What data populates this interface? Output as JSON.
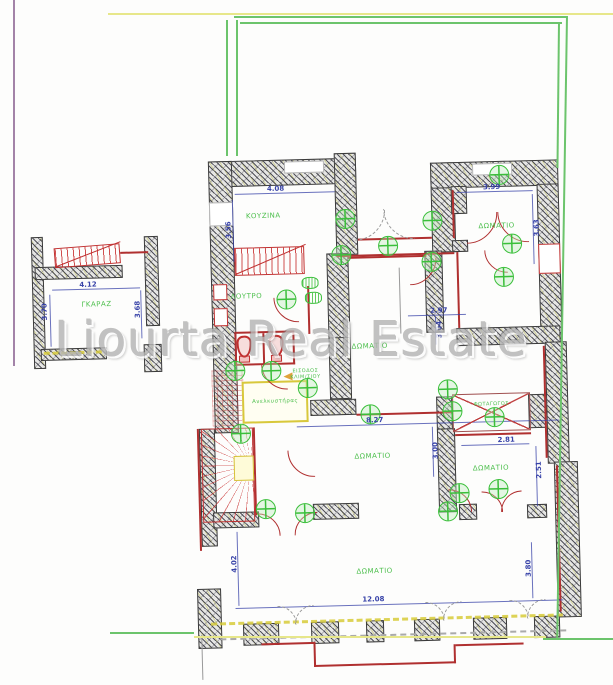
{
  "watermark": {
    "text": "Liourta Real Estate"
  },
  "colors": {
    "boundary_green": "#6cc46c",
    "line_yellow": "#e7e78a",
    "line_purple": "#a383a8",
    "wall_dark": "#3a3a3a",
    "dimension_blue": "#3742a8",
    "door_red": "#b03030",
    "label_green": "#4cbf4c",
    "symbol_green": "#3abf3a",
    "elevator_yellow": "#d8c83c",
    "watermark_gray": "#b5b5b5"
  },
  "plan": {
    "labels": [
      {
        "id": "kitchen",
        "text": "ΚΟΥΖΙΝΑ",
        "x": 268,
        "y": 213
      },
      {
        "id": "room-top-right",
        "text": "ΔΩΜΑΤΙΟ",
        "x": 501,
        "y": 229
      },
      {
        "id": "garage",
        "text": "ΓΚΑΡΑΖ",
        "x": 99,
        "y": 297
      },
      {
        "id": "bathroom",
        "text": "ΛΟΥΤΡΟ",
        "x": 249,
        "y": 293
      },
      {
        "id": "room-middle",
        "text": "ΔΩΜΑΤΙΟ",
        "x": 371,
        "y": 346
      },
      {
        "id": "stair-entrance",
        "text": "ΕΙΣΟΔΟΣ\nΚΛΙΜ/ΣΙΟΥ",
        "x": 306,
        "y": 372,
        "size": 5
      },
      {
        "id": "elevator",
        "text": "Ανελκυστήρας",
        "x": 275,
        "y": 399,
        "size": 5.5
      },
      {
        "id": "lightwell",
        "text": "ΦΩΤΑΓΩΓΟΣ",
        "x": 491,
        "y": 407,
        "size": 5
      },
      {
        "id": "room-mid-bottom",
        "text": "ΔΩΜΑΤΙΟ",
        "x": 371,
        "y": 456
      },
      {
        "id": "room-bottom-right",
        "text": "ΔΩΜΑΤΙΟ",
        "x": 489,
        "y": 471
      },
      {
        "id": "room-bottom",
        "text": "ΔΩΜΑΤΙΟ",
        "x": 370,
        "y": 571
      }
    ],
    "dimensions": [
      {
        "text": "4.08",
        "x": 281,
        "y": 186,
        "vertical": false
      },
      {
        "text": "3.56",
        "x": 233,
        "y": 226,
        "vertical": true
      },
      {
        "text": "3.99",
        "x": 497,
        "y": 190,
        "vertical": false
      },
      {
        "text": "3.63",
        "x": 541,
        "y": 232,
        "vertical": true
      },
      {
        "text": "4.12",
        "x": 91,
        "y": 277,
        "vertical": false
      },
      {
        "text": "3.70",
        "x": 47,
        "y": 303,
        "vertical": true
      },
      {
        "text": "3.68",
        "x": 140,
        "y": 303,
        "vertical": true
      },
      {
        "text": "2.97",
        "x": 441,
        "y": 312,
        "vertical": false
      },
      {
        "text": "3.04",
        "x": 441,
        "y": 331,
        "vertical": true
      },
      {
        "text": "8.27",
        "x": 374,
        "y": 420,
        "vertical": false
      },
      {
        "text": "3.00",
        "x": 434,
        "y": 452,
        "vertical": true
      },
      {
        "text": "2.81",
        "x": 505,
        "y": 443,
        "vertical": false
      },
      {
        "text": "2.51",
        "x": 537,
        "y": 474,
        "vertical": true
      },
      {
        "text": "12.08",
        "x": 368,
        "y": 599,
        "vertical": false
      },
      {
        "text": "4.02",
        "x": 230,
        "y": 560,
        "vertical": true
      },
      {
        "text": "3.80",
        "x": 524,
        "y": 572,
        "vertical": true
      }
    ],
    "lights": [
      [
        350,
        218
      ],
      [
        437,
        222
      ],
      [
        505,
        178
      ],
      [
        516,
        247
      ],
      [
        392,
        246
      ],
      [
        345,
        254
      ],
      [
        435,
        263
      ],
      [
        507,
        280
      ],
      [
        289,
        297
      ],
      [
        236,
        367
      ],
      [
        272,
        368
      ],
      [
        308,
        386
      ],
      [
        240,
        430
      ],
      [
        370,
        414
      ],
      [
        448,
        391
      ],
      [
        452,
        413
      ],
      [
        494,
        420
      ],
      [
        263,
        506
      ],
      [
        302,
        511
      ],
      [
        457,
        495
      ],
      [
        445,
        513
      ],
      [
        496,
        492
      ]
    ],
    "tags": [
      [
        313,
        281
      ],
      [
        316,
        296
      ]
    ],
    "arcs": [
      [
        358,
        208,
        30,
        "br",
        "#999999",
        1
      ],
      [
        418,
        208,
        30,
        "bl",
        "#999999",
        1
      ],
      [
        470,
        214,
        30,
        "br",
        "#b03030",
        0
      ],
      [
        532,
        214,
        30,
        "bl",
        "#b03030",
        0
      ],
      [
        300,
        294,
        24,
        "bl",
        "#b03030",
        0
      ],
      [
        412,
        258,
        26,
        "br",
        "#b03030",
        0
      ],
      [
        510,
        252,
        22,
        "bl",
        "#b03030",
        0
      ],
      [
        287,
        360,
        25,
        "bl",
        "#b03030",
        0
      ],
      [
        312,
        447,
        26,
        "bl",
        "#b03030",
        0
      ],
      [
        253,
        532,
        22,
        "tr",
        "#b03030",
        0
      ],
      [
        313,
        532,
        22,
        "tl",
        "#b03030",
        0
      ],
      [
        445,
        513,
        22,
        "tr",
        "#b03030",
        0
      ],
      [
        478,
        514,
        20,
        "tr",
        "#b03030",
        0
      ],
      [
        518,
        514,
        20,
        "tl",
        "#b03030",
        0
      ],
      [
        271,
        621,
        18,
        "tr",
        "#999999",
        1
      ],
      [
        307,
        621,
        18,
        "tl",
        "#999999",
        1
      ],
      [
        419,
        621,
        18,
        "tr",
        "#999999",
        1
      ],
      [
        455,
        621,
        18,
        "tl",
        "#999999",
        1
      ],
      [
        503,
        621,
        18,
        "tr",
        "#999999",
        1
      ],
      [
        539,
        621,
        18,
        "tl",
        "#999999",
        1
      ]
    ]
  }
}
